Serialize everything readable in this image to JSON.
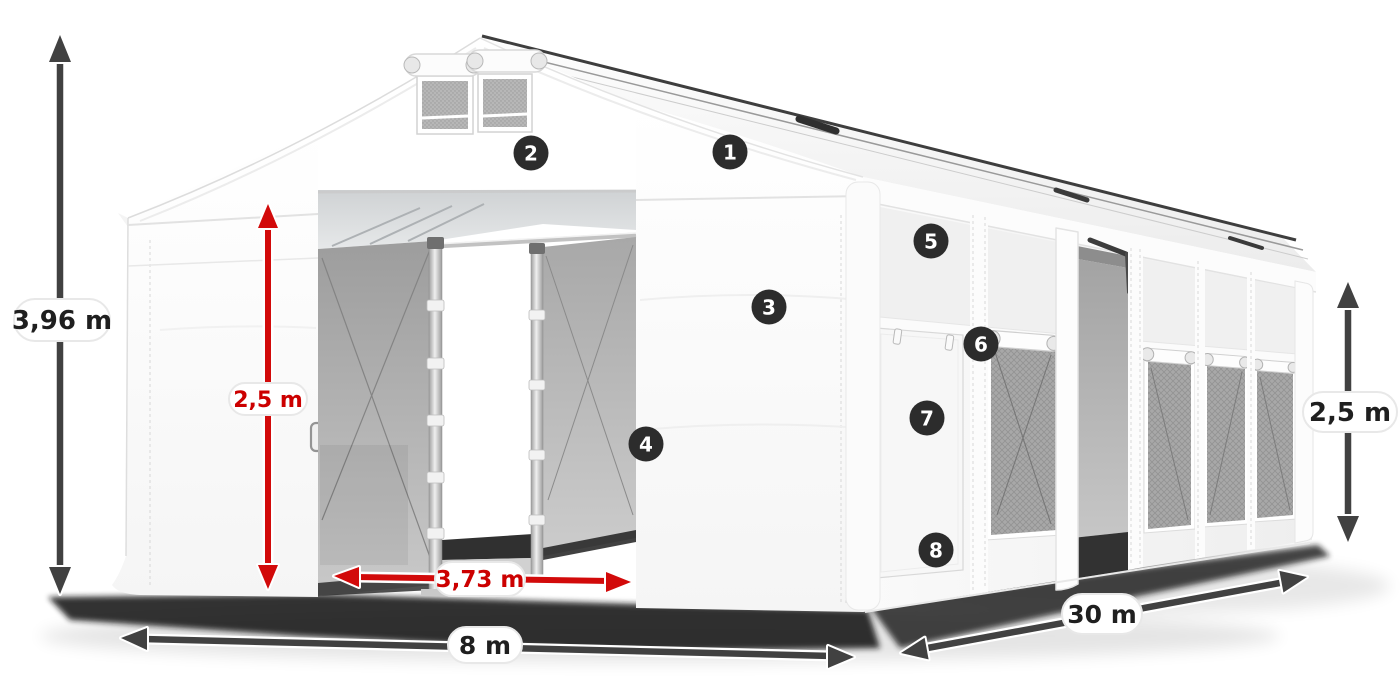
{
  "figure": {
    "type": "product-dimension-diagram",
    "subject": "White tarpaulin storage hall tent with open front gates, side windows, numbered feature callouts and dimension arrows",
    "background_color": "#ffffff"
  },
  "dimension_labels": {
    "total_height": {
      "text": "3,96 m",
      "color": "#1f1f1f"
    },
    "gate_height": {
      "text": "2,5 m",
      "color": "#cc0000"
    },
    "gate_width": {
      "text": "3,73 m",
      "color": "#cc0000"
    },
    "front_width": {
      "text": "8 m",
      "color": "#1f1f1f"
    },
    "side_length": {
      "text": "30 m",
      "color": "#1f1f1f"
    },
    "side_wall_height": {
      "text": "2,5 m",
      "color": "#1f1f1f"
    }
  },
  "callout_badges": [
    {
      "number": "1"
    },
    {
      "number": "2"
    },
    {
      "number": "3"
    },
    {
      "number": "4"
    },
    {
      "number": "5"
    },
    {
      "number": "6"
    },
    {
      "number": "7"
    },
    {
      "number": "8"
    }
  ],
  "style_colors": {
    "arrow_dark": "#414141",
    "arrow_red": "#d20a0a",
    "badge_background": "#2c2c2c",
    "badge_number": "#ffffff",
    "label_pill_background": "#ffffff"
  }
}
